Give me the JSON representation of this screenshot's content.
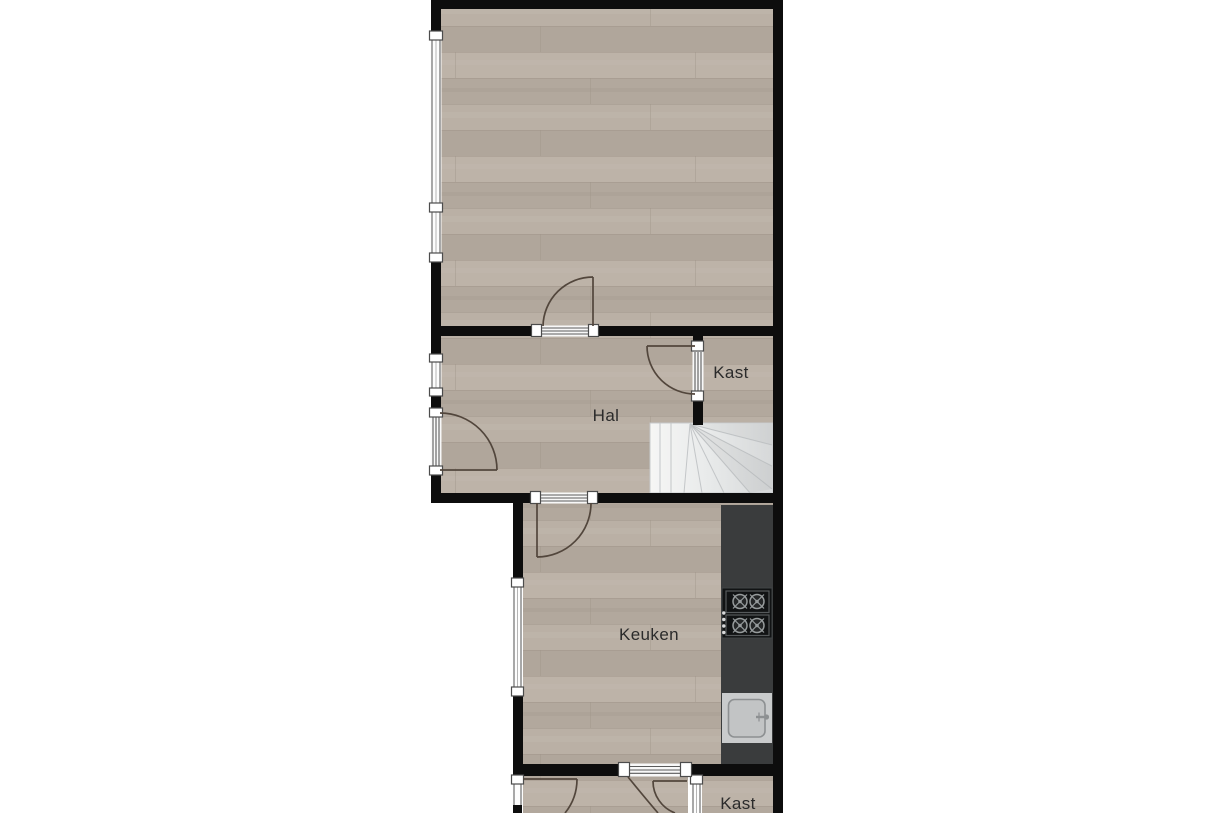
{
  "document": {
    "type": "floor-plan",
    "label_language": "Dutch"
  },
  "labels": {
    "hal": "Hal",
    "kast_upper": "Kast",
    "keuken": "Keuken",
    "kast_lower": "Kast"
  },
  "fixtures": {
    "stairs": "winder-staircase",
    "stove": "4-burner-cooktop",
    "sink": "kitchen-sink",
    "counter": "kitchen-counter"
  },
  "colors": {
    "background": "#ffffff",
    "wall": "#0d0d0d",
    "wood_floor": "#b5ab9f",
    "counter": "#3a3c3d",
    "cooktop": "#111314",
    "stairs": "#e9ebeb",
    "door_line": "#52463c",
    "label_text": "#2b2b2b"
  }
}
